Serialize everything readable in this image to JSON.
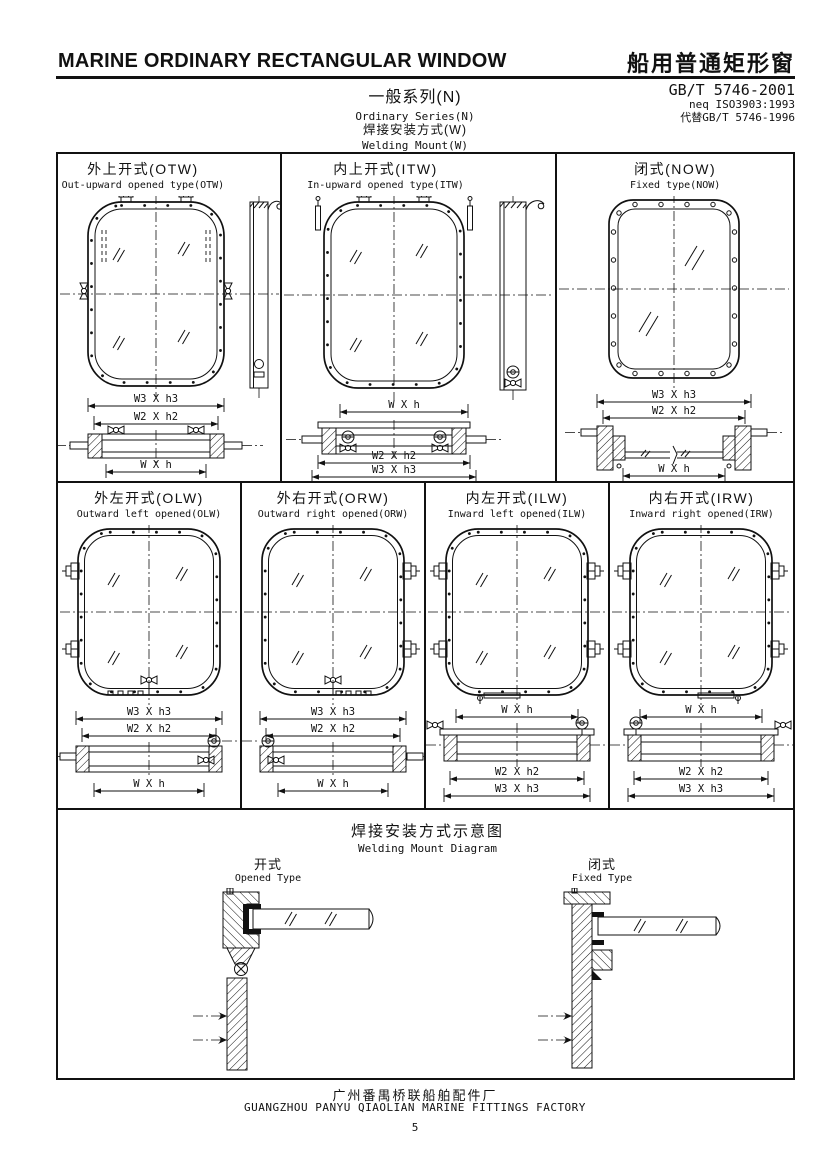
{
  "header": {
    "title_en": "MARINE ORDINARY RECTANGULAR WINDOW",
    "title_zh": "船用普通矩形窗",
    "standard": {
      "code": "GB/T 5746-2001",
      "equivalence": "neq ISO3903:1993",
      "replaces": "代替GB/T 5746-1996"
    },
    "series_zh": "一般系列(N)",
    "series_en": "Ordinary Series(N)",
    "mount_zh": "焊接安装方式(W)",
    "mount_en": "Welding Mount(W)"
  },
  "panels_row1": [
    {
      "id": "OTW",
      "title_zh": "外上开式(OTW)",
      "title_en": "Out-upward opened type(OTW)",
      "dims": [
        "W3 X h3",
        "W2 X h2",
        "W X h"
      ]
    },
    {
      "id": "ITW",
      "title_zh": "内上开式(ITW)",
      "title_en": "In-upward opened type(ITW)",
      "dims": [
        "W X h",
        "W2 X h2",
        "W3 X h3"
      ]
    },
    {
      "id": "NOW",
      "title_zh": "闭式(NOW)",
      "title_en": "Fixed type(NOW)",
      "dims": [
        "W3 X h3",
        "W2 X h2",
        "W X h"
      ]
    }
  ],
  "panels_row2": [
    {
      "id": "OLW",
      "title_zh": "外左开式(OLW)",
      "title_en": "Outward left opened(OLW)",
      "dims": [
        "W3 X h3",
        "W2 X h2",
        "W X h"
      ]
    },
    {
      "id": "ORW",
      "title_zh": "外右开式(ORW)",
      "title_en": "Outward right opened(ORW)",
      "dims": [
        "W3 X h3",
        "W2 X h2",
        "W X h"
      ]
    },
    {
      "id": "ILW",
      "title_zh": "内左开式(ILW)",
      "title_en": "Inward left opened(ILW)",
      "dims": [
        "W X h",
        "W2 X h2",
        "W3 X h3"
      ]
    },
    {
      "id": "IRW",
      "title_zh": "内右开式(IRW)",
      "title_en": "Inward right opened(IRW)",
      "dims": [
        "W X h",
        "W2 X h2",
        "W3 X h3"
      ]
    }
  ],
  "welding": {
    "title_zh": "焊接安装方式示意图",
    "title_en": "Welding Mount Diagram",
    "opened_zh": "开式",
    "opened_en": "Opened Type",
    "fixed_zh": "闭式",
    "fixed_en": "Fixed Type"
  },
  "footer": {
    "factory_zh": "广州番禺桥联船舶配件厂",
    "factory_en": "GUANGZHOU PANYU QIAOLIAN MARINE FITTINGS FACTORY",
    "page_number": "5"
  },
  "colors": {
    "ink": "#111111",
    "paper": "#ffffff"
  }
}
